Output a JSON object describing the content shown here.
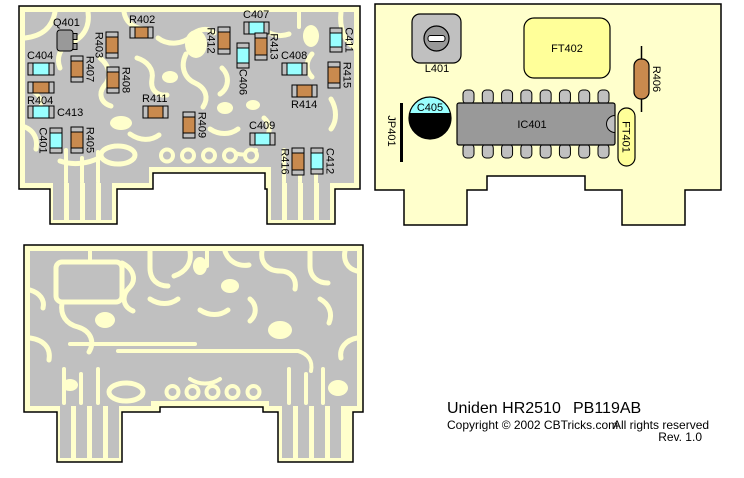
{
  "caption": {
    "title": "Uniden HR2510",
    "board_id": "PB119AB",
    "copyright": "Copyright © 2002 CBTricks.com",
    "rights": "All rights reserved",
    "revision": "Rev. 1.0"
  },
  "colors": {
    "board": "#FFFFCC",
    "copper": "#C0C0C0",
    "resistor": "#C98A4E",
    "capacitor": "#99FFFF",
    "component_gray": "#999999",
    "filter_yellow": "#FFFF99",
    "white": "#FFFFFF",
    "black": "#000000",
    "outline": "#000000"
  },
  "component_board": {
    "description": "component placement view",
    "smd": [
      {
        "id": "R402",
        "x": 130,
        "y": 27,
        "w": 23,
        "h": 11,
        "o": "h",
        "lab": "above"
      },
      {
        "id": "C407",
        "x": 244,
        "y": 22,
        "w": 25,
        "h": 12,
        "o": "h",
        "lab": "above"
      },
      {
        "id": "C411",
        "x": 330,
        "y": 28,
        "w": 12,
        "h": 24,
        "o": "v",
        "lab": "right-rot"
      },
      {
        "id": "R412",
        "x": 218,
        "y": 27,
        "w": 12,
        "h": 27,
        "o": "v",
        "lab": "left-rot"
      },
      {
        "id": "R403",
        "x": 106,
        "y": 32,
        "w": 12,
        "h": 26,
        "o": "v",
        "lab": "left-rot"
      },
      {
        "id": "R413",
        "x": 255,
        "y": 33,
        "w": 12,
        "h": 27,
        "o": "v",
        "lab": "right-rot"
      },
      {
        "id": "C404",
        "x": 28,
        "y": 63,
        "w": 26,
        "h": 12,
        "o": "h",
        "lab": "above"
      },
      {
        "id": "R407",
        "x": 71,
        "y": 56,
        "w": 12,
        "h": 26,
        "o": "v",
        "lab": "right-rot"
      },
      {
        "id": "C408",
        "x": 282,
        "y": 63,
        "w": 25,
        "h": 12,
        "o": "h",
        "lab": "above"
      },
      {
        "id": "R415",
        "x": 328,
        "y": 62,
        "w": 12,
        "h": 26,
        "o": "v",
        "lab": "right-rot"
      },
      {
        "id": "C406",
        "x": 237,
        "y": 43,
        "w": 12,
        "h": 25,
        "o": "v",
        "lab": "below-rot"
      },
      {
        "id": "R404",
        "x": 28,
        "y": 82,
        "w": 26,
        "h": 11,
        "o": "h",
        "lab": "below"
      },
      {
        "id": "R408",
        "x": 107,
        "y": 67,
        "w": 12,
        "h": 26,
        "o": "v",
        "lab": "right-rot"
      },
      {
        "id": "R414",
        "x": 292,
        "y": 85,
        "w": 25,
        "h": 12,
        "o": "h",
        "lab": "below"
      },
      {
        "id": "C413",
        "x": 28,
        "y": 106,
        "w": 26,
        "h": 12,
        "o": "h",
        "lab": "right"
      },
      {
        "id": "R411",
        "x": 143,
        "y": 106,
        "w": 25,
        "h": 12,
        "o": "h",
        "lab": "above"
      },
      {
        "id": "R409",
        "x": 183,
        "y": 112,
        "w": 12,
        "h": 26,
        "o": "v",
        "lab": "right-rot"
      },
      {
        "id": "C409",
        "x": 250,
        "y": 133,
        "w": 25,
        "h": 12,
        "o": "h",
        "lab": "above"
      },
      {
        "id": "C401",
        "x": 50,
        "y": 128,
        "w": 12,
        "h": 25,
        "o": "v",
        "lab": "left-rot"
      },
      {
        "id": "R405",
        "x": 71,
        "y": 127,
        "w": 12,
        "h": 26,
        "o": "v",
        "lab": "right-rot"
      },
      {
        "id": "R416",
        "x": 292,
        "y": 148,
        "w": 12,
        "h": 27,
        "o": "v",
        "lab": "left-rot"
      },
      {
        "id": "C412",
        "x": 311,
        "y": 148,
        "w": 12,
        "h": 26,
        "o": "v",
        "lab": "right-rot"
      }
    ],
    "transistor": {
      "id": "Q401",
      "x": 57,
      "y": 30,
      "w": 16,
      "h": 21,
      "lab_x": 53,
      "lab_y": 26
    },
    "holes": {
      "cx": [
        167,
        188,
        209,
        230,
        251
      ],
      "cy": 155.5,
      "r": 6
    },
    "oval": {
      "cx": 118,
      "cy": 155,
      "rx": 17,
      "ry": 9
    }
  },
  "parts_board": {
    "description": "through-hole parts view",
    "trimmer": {
      "id": "L401",
      "x": 412,
      "y": 14,
      "w": 49,
      "h": 49,
      "lab_x": 437,
      "lab_y": 72
    },
    "filter_big": {
      "id": "FT402",
      "x": 524,
      "y": 18,
      "w": 86,
      "h": 60
    },
    "axial_resistor": {
      "id": "R406",
      "cx": 641.5,
      "body_y": 59,
      "body_w": 15,
      "body_h": 40,
      "lead_top": 46,
      "lead_bot": 112,
      "lab_cx": 657,
      "lab_cy": 79
    },
    "cap_electrolytic": {
      "id": "C405",
      "cx": 430,
      "cy": 118,
      "r": 21,
      "chord_y": 113
    },
    "jumper": {
      "id": "JP401",
      "x": 401.5,
      "y1": 103,
      "y2": 162,
      "lab_cx": 392,
      "lab_cy": 131
    },
    "ic": {
      "id": "IC401",
      "x": 457,
      "y": 103,
      "w": 158,
      "h": 42,
      "pins_per_side": 8,
      "lab_cx": 532,
      "lab_cy": 128
    },
    "filter_small": {
      "id": "FT401",
      "x": 618,
      "y": 108,
      "w": 17,
      "h": 58,
      "lab_cx": 626.5,
      "lab_cy": 137
    }
  },
  "trace_board": {
    "description": "copper trace view"
  }
}
